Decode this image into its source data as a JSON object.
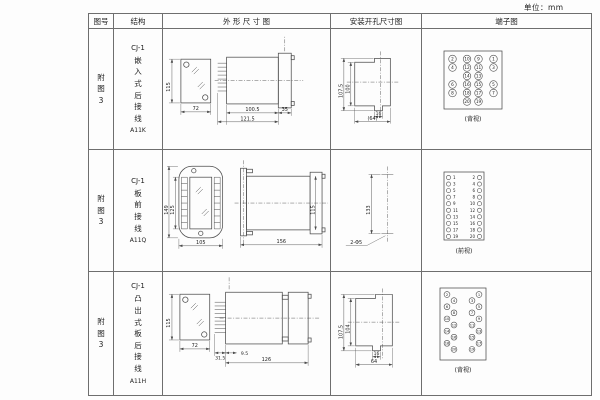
{
  "page": {
    "unit_label": "单位：mm"
  },
  "table": {
    "headers": {
      "fig": "图号",
      "structure": "结构",
      "outline": "外 形 尺 寸 图",
      "mounting": "安装开孔尺寸图",
      "terminal": "端子图"
    },
    "rows": [
      {
        "fig": "附图3",
        "model": "CJ-1",
        "type": "嵌入式后接线",
        "code": "A11K",
        "outline": {
          "h": "115",
          "w": "72",
          "d1": "100.5",
          "d2": "121.5",
          "d3": "35"
        },
        "mounting": {
          "h1": "107.5",
          "h2": "100",
          "w1": "16",
          "w2": "(64)"
        },
        "terminal": {
          "caption": "(背视)",
          "grid": [
            [
              "2",
              "10",
              "9",
              "1"
            ],
            [
              "4",
              "12",
              "11",
              "3"
            ],
            [
              "",
              "14",
              "13",
              ""
            ],
            [
              "6",
              "16",
              "15",
              "5"
            ],
            [
              "8",
              "18",
              "17",
              "7"
            ],
            [
              "",
              "20",
              "19",
              ""
            ]
          ]
        }
      },
      {
        "fig": "附图3",
        "model": "CJ-1",
        "type": "板前接线",
        "code": "A11Q",
        "outline": {
          "h1": "149",
          "h2": "125",
          "w": "105",
          "d": "156",
          "side_h": "115"
        },
        "mounting": {
          "h": "133",
          "holes": "2-Φ5"
        },
        "terminal": {
          "caption": "(前视)",
          "pairs": [
            [
              "1",
              "2"
            ],
            [
              "3",
              "4"
            ],
            [
              "5",
              "6"
            ],
            [
              "7",
              "8"
            ],
            [
              "9",
              "10"
            ],
            [
              "11",
              "12"
            ],
            [
              "13",
              "14"
            ],
            [
              "15",
              "16"
            ],
            [
              "17",
              "18"
            ],
            [
              "19",
              "20"
            ]
          ]
        }
      },
      {
        "fig": "附图3",
        "model": "CJ-1",
        "type": "凸出式板后接线",
        "code": "A11H",
        "outline": {
          "h": "115",
          "w": "72",
          "d1": "31.5",
          "d2": "9.5",
          "d3": "126"
        },
        "mounting": {
          "h1": "107.5",
          "h2": "104",
          "w1": "16",
          "w2": "64"
        },
        "terminal": {
          "caption": "(背视)",
          "left": [
            "2",
            "4",
            "6",
            "8",
            "10",
            "12",
            "14",
            "16",
            "18",
            "20"
          ],
          "right": [
            "1",
            "3",
            "5",
            "7",
            "9",
            "11",
            "13",
            "15",
            "17",
            "19"
          ]
        }
      }
    ]
  }
}
